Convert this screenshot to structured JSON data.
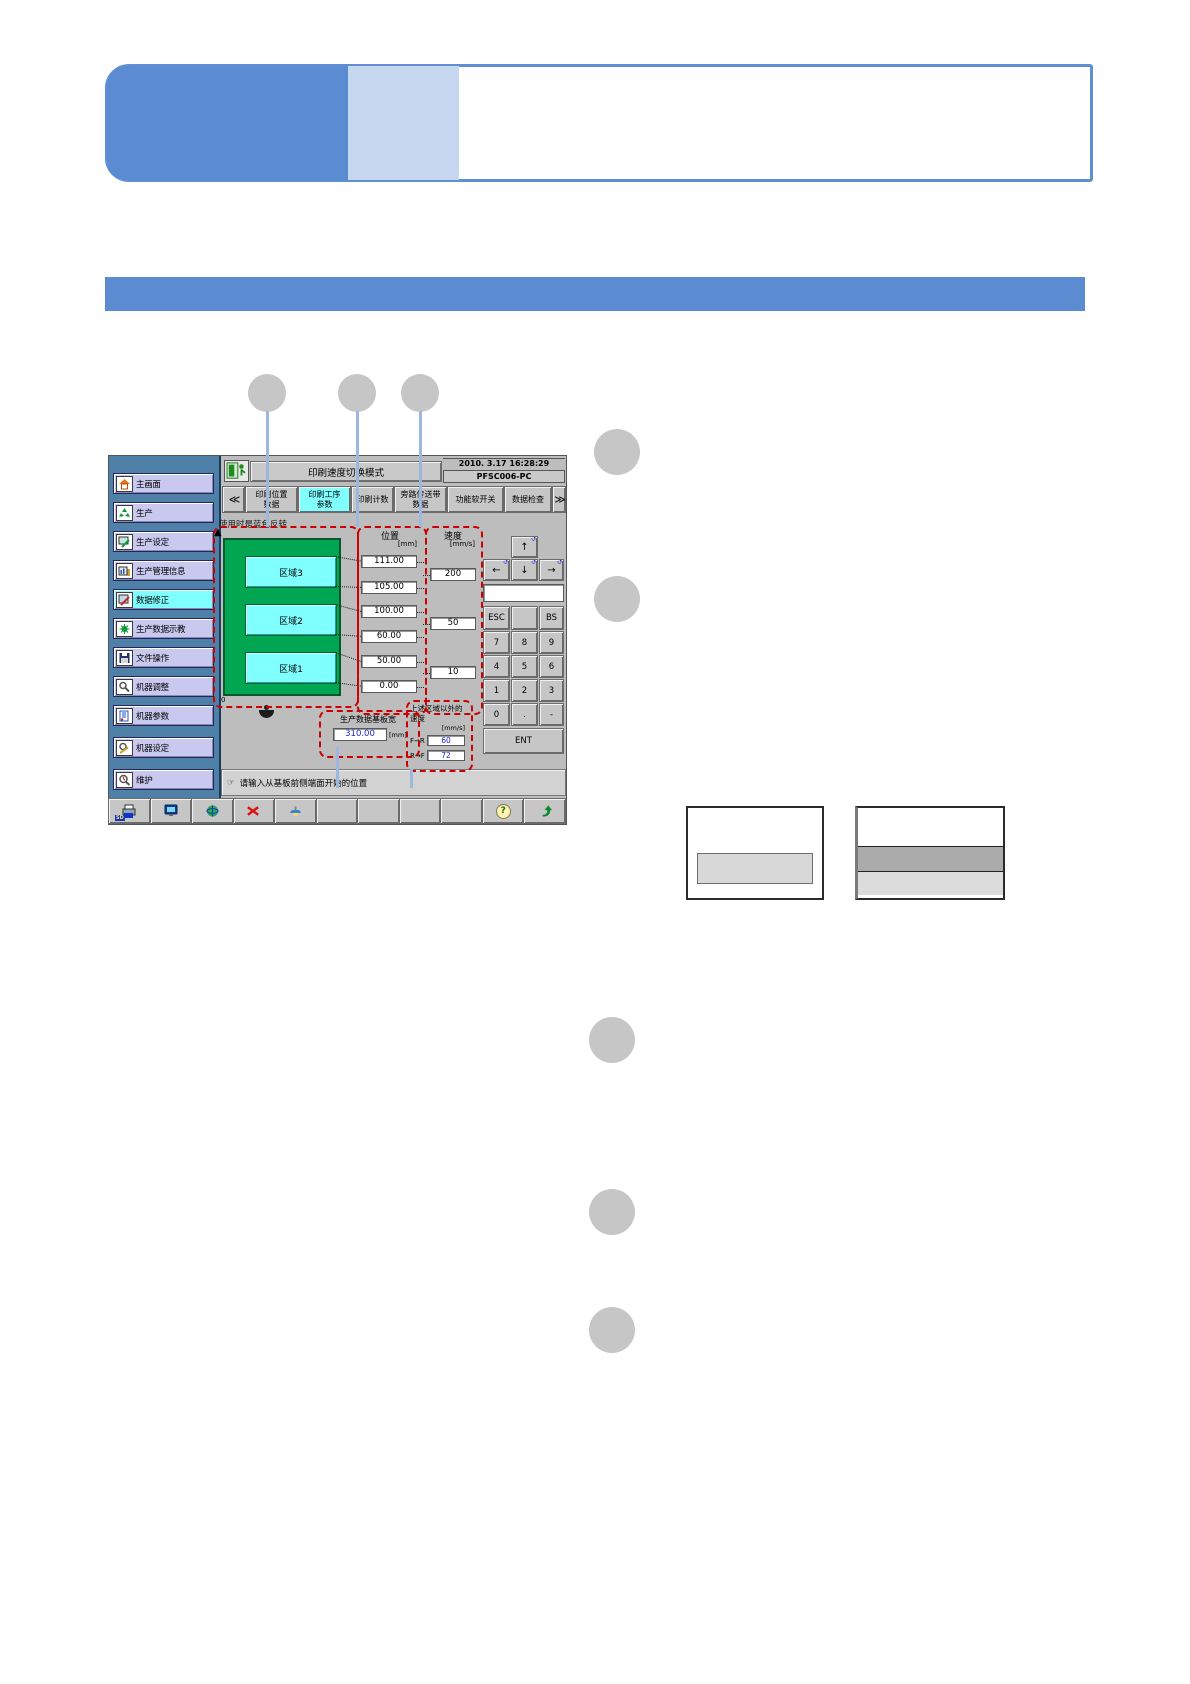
{
  "colors": {
    "accent_blue": "#5B8BD0",
    "banner_light_blue": "#C5D8F0",
    "highlight_cyan": "#80FFFF",
    "region_green": "#00A651",
    "region_cyan": "#80FFFF",
    "callout_dash_red": "#CC0000",
    "value_blue": "#2222CC",
    "callout_line_blue": "#9DB8DF",
    "sidebar_blue": "#4E80A8"
  },
  "screen": {
    "titlebar": {
      "title": "印刷速度切换模式",
      "datetime": "2010. 3.17 16:28:29",
      "device": "PFSC006-PC"
    },
    "tabs": {
      "prev": "≪",
      "next": "≫",
      "items": [
        {
          "line1": "印刷位置",
          "line2": "数据"
        },
        {
          "line1": "印刷工序",
          "line2": "参数"
        },
        {
          "line1": "印刷计数",
          "line2": ""
        },
        {
          "line1": "旁路传送带",
          "line2": "数据"
        },
        {
          "line1": "功能软开关",
          "line2": ""
        },
        {
          "line1": "数据检查",
          "line2": ""
        }
      ]
    },
    "sidebar": {
      "items": [
        {
          "label": "主画面"
        },
        {
          "label": "生产"
        },
        {
          "label": "生产设定"
        },
        {
          "label": "生产管理信息"
        },
        {
          "label": "数据修正"
        },
        {
          "label": "生产数据示教"
        },
        {
          "label": "文件操作"
        },
        {
          "label": "机器调整"
        },
        {
          "label": "机器参数"
        },
        {
          "label": "机器设定"
        },
        {
          "label": "维护"
        }
      ]
    },
    "note": "使用时是蓝色反转",
    "diagram": {
      "regions": [
        "区域3",
        "区域2",
        "区域1"
      ],
      "zero_label": "0",
      "axis_arrow": "▲"
    },
    "position": {
      "header": "位置",
      "unit": "[mm]",
      "values": [
        "111.00",
        "105.00",
        "100.00",
        "60.00",
        "50.00",
        "0.00"
      ]
    },
    "speed": {
      "header": "速度",
      "unit": "[mm/s]",
      "values": [
        "200",
        "50",
        "10"
      ]
    },
    "base_width": {
      "label": "生产数据基板宽",
      "value": "310.00",
      "unit": "[mm]"
    },
    "outside_speed": {
      "label_line1": "上述区域以外的",
      "label_line2": "速度",
      "unit": "[mm/s]",
      "rows": [
        {
          "dir": "F→R",
          "value": "60"
        },
        {
          "dir": "R→F",
          "value": "72"
        }
      ]
    },
    "keypad": {
      "arrows": {
        "up": "↑",
        "down": "↓",
        "left": "←",
        "right": "→"
      },
      "keys": [
        "ESC",
        "",
        "BS",
        "7",
        "8",
        "9",
        "4",
        "5",
        "6",
        "1",
        "2",
        "3",
        "0",
        ".",
        "-"
      ],
      "enter": "ENT"
    },
    "statusbar": {
      "hand": "☞",
      "message": "请输入从基板前侧端面开始的位置"
    },
    "toolbar": {
      "sd_label": "SD",
      "help_glyph": "?"
    }
  }
}
